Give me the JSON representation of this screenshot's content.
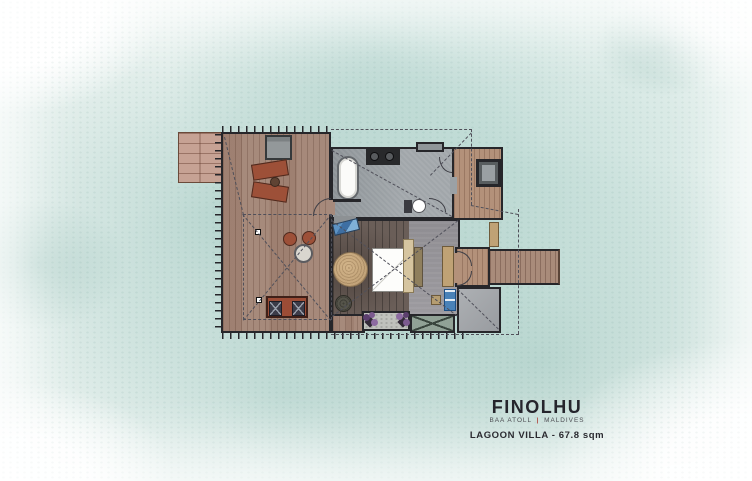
{
  "branding": {
    "name": "FINOLHU",
    "subtitle_left": "BAA ATOLL",
    "subtitle_separator": "|",
    "subtitle_right": "MALDIVES",
    "plan_title": "LAGOON VILLA - 67.8 sqm"
  },
  "colors": {
    "water_wash": "#9fc6bd",
    "wall": "#26262a",
    "dash_line": "#50505a",
    "deck_wood": "#a68a7c",
    "stairs_wood": "#c6a294",
    "walkway_wood": "#a98b7a",
    "interior_deck_wood": "#b3917a",
    "bedroom_floor": "#6a5e58",
    "bedroom_gray_floor": "#97959a",
    "bathroom_floor": "#9ba1a5",
    "entry_floor": "#a4a7ab",
    "lounge_rust": "#9d5038",
    "sofa_rust": "#9c4c36",
    "rug_tan": "#c2a379",
    "headboard_tan": "#d6c5a0",
    "wardrobe_tan": "#bfa275",
    "blue_accent": "#4a82b8",
    "plant_purple": "#7c5a8f",
    "brand_text": "#25252c",
    "brand_red": "#b0453c"
  }
}
